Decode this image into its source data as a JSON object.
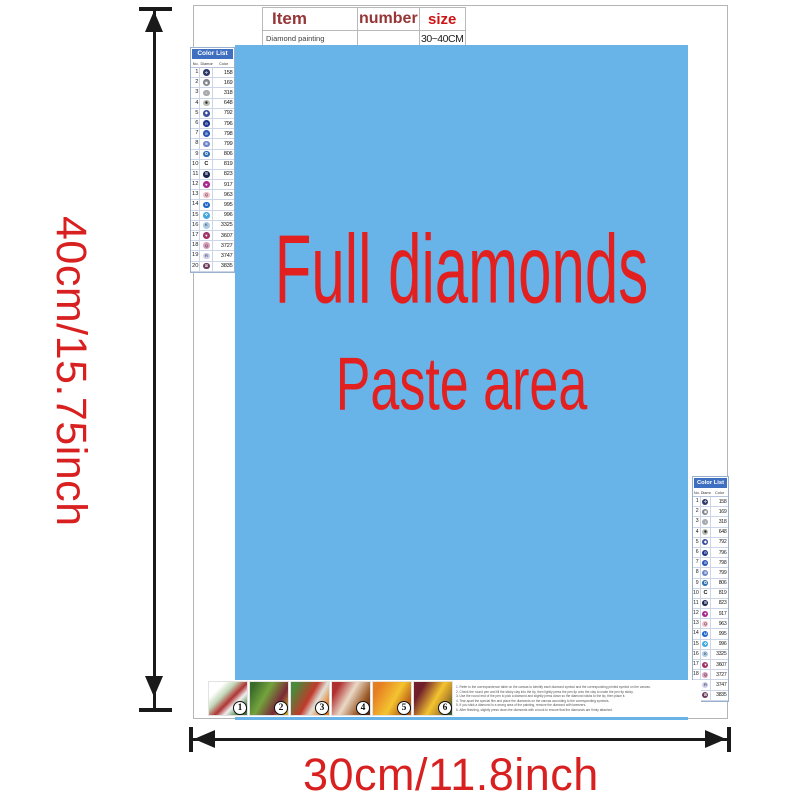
{
  "dimensions": {
    "height_label": "40cm/15.75inch",
    "width_label": "30cm/11.8inch",
    "label_color": "#d92020"
  },
  "item_table": {
    "headers": {
      "item": "Item",
      "number": "number",
      "size": "size"
    },
    "row": {
      "item": "Diamond painting",
      "number": "",
      "size": "30~40CM"
    }
  },
  "paste_area": {
    "line1": "Full diamonds",
    "line2": "Paste area",
    "bg_color": "#68b4e9",
    "text_color": "#e32020"
  },
  "color_list": {
    "title": "Color List",
    "columns": [
      "No.",
      "Diamond",
      "Color"
    ],
    "header_bg": "#3e6fc0",
    "rows": [
      {
        "no": "1",
        "symbol": "✛",
        "code": "158",
        "circle": "#2e3a69",
        "light": false
      },
      {
        "no": "2",
        "symbol": "◉",
        "code": "169",
        "circle": "#82868d",
        "light": false
      },
      {
        "no": "3",
        "symbol": "♁",
        "code": "318",
        "circle": "#a6a9ae",
        "light": false
      },
      {
        "no": "4",
        "symbol": "✱",
        "code": "648",
        "circle": "#babdb3",
        "light": true
      },
      {
        "no": "5",
        "symbol": "◆",
        "code": "792",
        "circle": "#3b4f9e",
        "light": false
      },
      {
        "no": "6",
        "symbol": "⊖",
        "code": "796",
        "circle": "#20368f",
        "light": false
      },
      {
        "no": "7",
        "symbol": "⊘",
        "code": "798",
        "circle": "#2c55b5",
        "light": false
      },
      {
        "no": "8",
        "symbol": "⊕",
        "code": "799",
        "circle": "#6d83c9",
        "light": false
      },
      {
        "no": "9",
        "symbol": "✪",
        "code": "806",
        "circle": "#2b6fb0",
        "light": false
      },
      {
        "no": "10",
        "symbol": "C",
        "code": "819",
        "circle": "none",
        "light": true
      },
      {
        "no": "11",
        "symbol": "⊞",
        "code": "823",
        "circle": "#1a2550",
        "light": false
      },
      {
        "no": "12",
        "symbol": "♥",
        "code": "917",
        "circle": "#a8288f",
        "light": false
      },
      {
        "no": "13",
        "symbol": "Q",
        "code": "963",
        "circle": "#f2bcc8",
        "light": true
      },
      {
        "no": "14",
        "symbol": "M",
        "code": "995",
        "circle": "#1e66c8",
        "light": false
      },
      {
        "no": "15",
        "symbol": "✜",
        "code": "996",
        "circle": "#45a8e0",
        "light": false
      },
      {
        "no": "16",
        "symbol": "K",
        "code": "3325",
        "circle": "#aacbe8",
        "light": true
      },
      {
        "no": "17",
        "symbol": "▼",
        "code": "3607",
        "circle": "#a03468",
        "light": false
      },
      {
        "no": "18",
        "symbol": "Q",
        "code": "3727",
        "circle": "#d9a0bd",
        "light": true
      },
      {
        "no": "19",
        "symbol": "R",
        "code": "3747",
        "circle": "#c9cdea",
        "light": true
      },
      {
        "no": "20",
        "symbol": "⊠",
        "code": "3835",
        "circle": "#6e3b5e",
        "light": false
      }
    ]
  },
  "steps": {
    "numbers": [
      "1",
      "2",
      "3",
      "4",
      "5",
      "6"
    ]
  },
  "instructions": [
    "1. Refer to the correspondence table on the canvas to identify each diamond symbol and the corresponding printed symbol on the canvas.",
    "2. Check the round pen and fill the sticky clay into the tip, then lightly press the pen tip onto the clay to make the pen tip sticky.",
    "3. Use the round end of the pen to pick a diamond and slightly press down so the diamond sticks to the tip, then place it.",
    "4. Tear apart the special film and place the diamonds on the canvas according to the corresponding symbols.",
    "5. If you stick a diamond in a wrong area of the painting, remove the diamond with tweezers.",
    "6. After finishing, slightly press down the diamonds with a book to ensure that the diamonds are firmly attached."
  ]
}
